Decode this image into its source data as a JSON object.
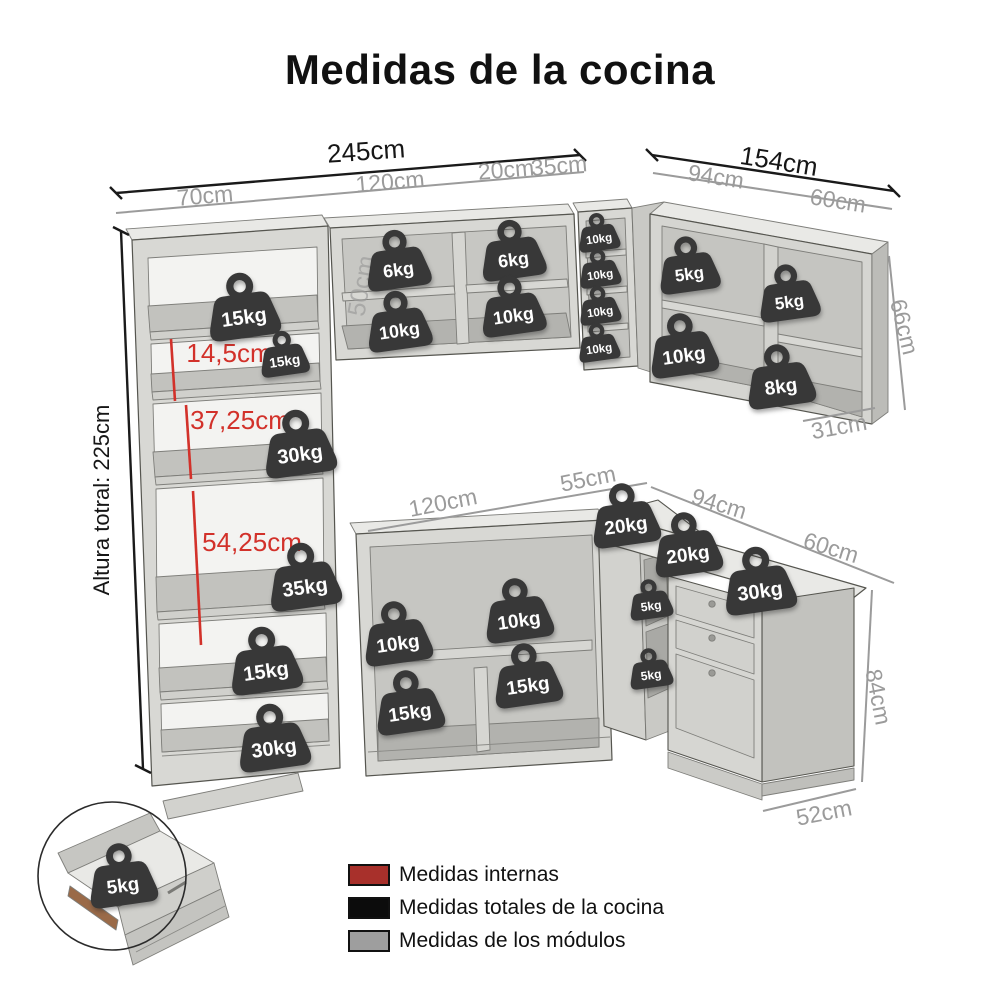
{
  "title": "Medidas de la cocina",
  "colors": {
    "internal": "#d2312a",
    "total": "#161616",
    "module": "#9b9b9b",
    "module_faint": "rgba(150,150,150,0.62)",
    "badge": "#383838"
  },
  "dimension_labels": [
    {
      "text": "245cm",
      "x": 366,
      "y": 151,
      "rot": -4,
      "type": "total",
      "size": 26
    },
    {
      "text": "154cm",
      "x": 779,
      "y": 161,
      "rot": 9,
      "type": "total",
      "size": 26
    },
    {
      "text": "Altura totral: 225cm",
      "x": 102,
      "y": 500,
      "rot": -90,
      "type": "total",
      "size": 22
    },
    {
      "text": "70cm",
      "x": 205,
      "y": 196,
      "rot": -5,
      "type": "module",
      "size": 23
    },
    {
      "text": "120cm",
      "x": 390,
      "y": 182,
      "rot": -5,
      "type": "module",
      "size": 23
    },
    {
      "text": "20cm",
      "x": 506,
      "y": 170,
      "rot": -5,
      "type": "module",
      "size": 23
    },
    {
      "text": "35cm",
      "x": 559,
      "y": 166,
      "rot": -5,
      "type": "module",
      "size": 23
    },
    {
      "text": "94cm",
      "x": 716,
      "y": 177,
      "rot": 9,
      "type": "module",
      "size": 23
    },
    {
      "text": "60cm",
      "x": 838,
      "y": 201,
      "rot": 9,
      "type": "module",
      "size": 23
    },
    {
      "text": "66cm",
      "x": 904,
      "y": 327,
      "rot": 76,
      "type": "module",
      "size": 23
    },
    {
      "text": "31cm",
      "x": 839,
      "y": 427,
      "rot": -10,
      "type": "module",
      "size": 23
    },
    {
      "text": "50cm",
      "x": 362,
      "y": 286,
      "rot": -80,
      "type": "module_faint",
      "size": 25
    },
    {
      "text": "120cm",
      "x": 443,
      "y": 503,
      "rot": -11,
      "type": "module",
      "size": 23
    },
    {
      "text": "55cm",
      "x": 588,
      "y": 479,
      "rot": -11,
      "type": "module",
      "size": 23
    },
    {
      "text": "94cm",
      "x": 719,
      "y": 504,
      "rot": 17,
      "type": "module",
      "size": 23
    },
    {
      "text": "60cm",
      "x": 831,
      "y": 548,
      "rot": 17,
      "type": "module",
      "size": 23
    },
    {
      "text": "84cm",
      "x": 878,
      "y": 697,
      "rot": 79,
      "type": "module",
      "size": 23
    },
    {
      "text": "52cm",
      "x": 824,
      "y": 813,
      "rot": -11,
      "type": "module",
      "size": 23
    },
    {
      "text": "14,5cm",
      "x": 229,
      "y": 353,
      "rot": 0,
      "type": "internal",
      "size": 26
    },
    {
      "text": "37,25cm",
      "x": 240,
      "y": 420,
      "rot": 0,
      "type": "internal",
      "size": 26
    },
    {
      "text": "54,25cm",
      "x": 252,
      "y": 542,
      "rot": 0,
      "type": "internal",
      "size": 26
    }
  ],
  "weights": [
    {
      "label": "15kg",
      "x": 243,
      "y": 303,
      "s": 1
    },
    {
      "label": "15kg",
      "x": 284,
      "y": 352,
      "s": 0.68
    },
    {
      "label": "30kg",
      "x": 299,
      "y": 440,
      "s": 1
    },
    {
      "label": "35kg",
      "x": 304,
      "y": 573,
      "s": 1
    },
    {
      "label": "15kg",
      "x": 265,
      "y": 657,
      "s": 1
    },
    {
      "label": "30kg",
      "x": 273,
      "y": 734,
      "s": 1
    },
    {
      "label": "6kg",
      "x": 398,
      "y": 257,
      "s": 0.9
    },
    {
      "label": "6kg",
      "x": 513,
      "y": 247,
      "s": 0.9
    },
    {
      "label": "10kg",
      "x": 399,
      "y": 318,
      "s": 0.9
    },
    {
      "label": "10kg",
      "x": 513,
      "y": 303,
      "s": 0.9
    },
    {
      "label": "10kg",
      "x": 599,
      "y": 231,
      "s": 0.58
    },
    {
      "label": "10kg",
      "x": 600,
      "y": 267,
      "s": 0.58
    },
    {
      "label": "10kg",
      "x": 600,
      "y": 304,
      "s": 0.58
    },
    {
      "label": "10kg",
      "x": 599,
      "y": 341,
      "s": 0.58
    },
    {
      "label": "5kg",
      "x": 688,
      "y": 262,
      "s": 0.85
    },
    {
      "label": "5kg",
      "x": 788,
      "y": 290,
      "s": 0.85
    },
    {
      "label": "10kg",
      "x": 683,
      "y": 342,
      "s": 0.95
    },
    {
      "label": "8kg",
      "x": 780,
      "y": 373,
      "s": 0.95
    },
    {
      "label": "20kg",
      "x": 625,
      "y": 512,
      "s": 0.95
    },
    {
      "label": "20kg",
      "x": 687,
      "y": 541,
      "s": 0.95
    },
    {
      "label": "30kg",
      "x": 759,
      "y": 577,
      "s": 1
    },
    {
      "label": "5kg",
      "x": 650,
      "y": 597,
      "s": 0.6
    },
    {
      "label": "5kg",
      "x": 650,
      "y": 666,
      "s": 0.6
    },
    {
      "label": "10kg",
      "x": 397,
      "y": 630,
      "s": 0.95
    },
    {
      "label": "10kg",
      "x": 518,
      "y": 607,
      "s": 0.95
    },
    {
      "label": "15kg",
      "x": 409,
      "y": 699,
      "s": 0.95
    },
    {
      "label": "15kg",
      "x": 527,
      "y": 672,
      "s": 0.95
    },
    {
      "label": "5kg",
      "x": 122,
      "y": 872,
      "s": 0.95
    }
  ],
  "legend": {
    "items": [
      {
        "label": "Medidas internas",
        "swatch": "#a8302b"
      },
      {
        "label": "Medidas totales de la cocina",
        "swatch": "#0c0c0c"
      },
      {
        "label": "Medidas de los módulos",
        "swatch": "#9e9e9e"
      }
    ]
  }
}
